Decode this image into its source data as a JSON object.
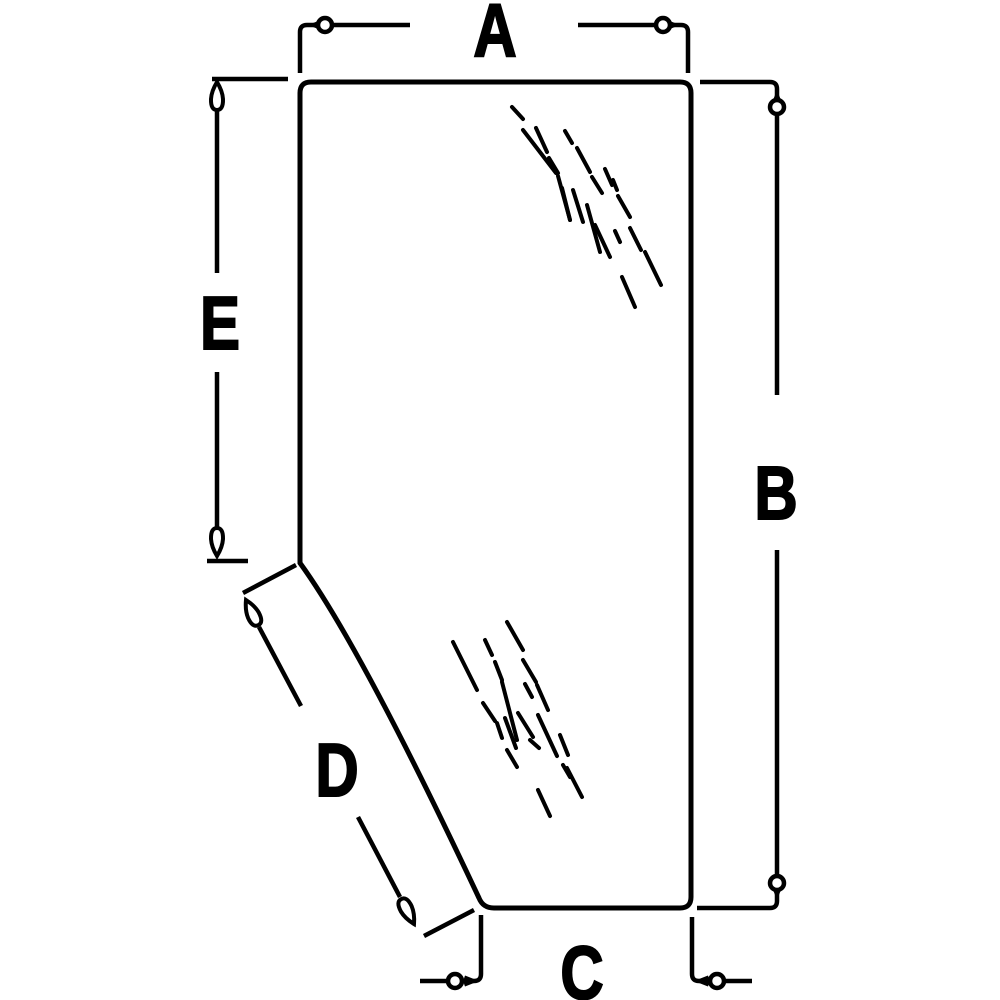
{
  "colors": {
    "background": "#ffffff",
    "line": "#000000"
  },
  "diagram": {
    "description": "technical-dimension-diagram-of-glass-panel",
    "canvas": {
      "width": 1000,
      "height": 1000
    },
    "glass_outline": "M 300 563 L 300 93 Q 300 82 311 82 L 680 82 Q 691 82 691 93 L 691 897 Q 691 908 680 908 L 494 908 Q 483 908 479 898 Q 361 647 300 563 Z",
    "hatch_clusters": [
      {
        "name": "upper-glass-shine",
        "strokes": [
          [
            512,
            107,
            523,
            119
          ],
          [
            523,
            130,
            556,
            173
          ],
          [
            536,
            128,
            547,
            152
          ],
          [
            549,
            158,
            558,
            173
          ],
          [
            565,
            131,
            572,
            143
          ],
          [
            558,
            176,
            570,
            220
          ],
          [
            577,
            148,
            590,
            172
          ],
          [
            562,
            188,
            570,
            220
          ],
          [
            573,
            190,
            583,
            222
          ],
          [
            592,
            177,
            602,
            193
          ],
          [
            605,
            169,
            612,
            185
          ],
          [
            587,
            205,
            600,
            252
          ],
          [
            595,
            225,
            610,
            257
          ],
          [
            613,
            180,
            617,
            190
          ],
          [
            618,
            196,
            630,
            217
          ],
          [
            615,
            231,
            620,
            242
          ],
          [
            630,
            228,
            641,
            250
          ],
          [
            645,
            252,
            661,
            285
          ],
          [
            622,
            277,
            635,
            307
          ]
        ]
      },
      {
        "name": "lower-glass-shine",
        "strokes": [
          [
            453,
            642,
            477,
            690
          ],
          [
            485,
            640,
            492,
            655
          ],
          [
            507,
            622,
            523,
            650
          ],
          [
            495,
            662,
            502,
            680
          ],
          [
            502,
            682,
            517,
            740
          ],
          [
            523,
            660,
            536,
            682
          ],
          [
            525,
            684,
            532,
            697
          ],
          [
            537,
            685,
            548,
            710
          ],
          [
            483,
            703,
            495,
            721
          ],
          [
            497,
            723,
            502,
            738
          ],
          [
            505,
            718,
            516,
            748
          ],
          [
            507,
            750,
            517,
            767
          ],
          [
            518,
            713,
            533,
            737
          ],
          [
            538,
            715,
            557,
            756
          ],
          [
            560,
            735,
            568,
            755
          ],
          [
            563,
            765,
            570,
            777
          ],
          [
            567,
            768,
            582,
            797
          ],
          [
            538,
            790,
            550,
            816
          ],
          [
            530,
            740,
            539,
            748
          ]
        ]
      }
    ],
    "dimensions": [
      {
        "label": "A",
        "paths": [
          "M 300 73 L 300 32 Q 300 25 307 25 L 410 25",
          "M 578 25 L 681 25 Q 688 25 688 32 L 688 73"
        ],
        "circles": [
          [
            325,
            25
          ],
          [
            663,
            25
          ]
        ],
        "arrows": [
          {
            "x": 308,
            "y": 25,
            "rot": 180
          },
          {
            "x": 680,
            "y": 25,
            "rot": 0
          }
        ],
        "teardrops": []
      },
      {
        "label": "B",
        "paths": [
          "M 700 82 L 770 82 Q 777 82 777 89 L 777 395",
          "M 777 550 L 777 901 Q 777 908 770 908 L 697 908"
        ],
        "circles": [
          [
            777,
            107
          ],
          [
            777,
            883
          ]
        ],
        "arrows": [
          {
            "x": 777,
            "y": 90,
            "rot": 270
          },
          {
            "x": 777,
            "y": 900,
            "rot": 90
          }
        ],
        "teardrops": []
      },
      {
        "label": "C",
        "paths": [
          "M 420 981 L 474 981 Q 481 981 481 974 L 481 915",
          "M 692 917 L 692 974 Q 692 981 699 981 L 752 981"
        ],
        "circles": [
          [
            455,
            981
          ],
          [
            717,
            981
          ]
        ],
        "arrows": [
          {
            "x": 479,
            "y": 981,
            "rot": 0
          },
          {
            "x": 694,
            "y": 981,
            "rot": 180
          }
        ],
        "teardrops": []
      },
      {
        "label": "D",
        "paths": [
          "M 296 565 L 243 593",
          "M 259 627 L 301 706",
          "M 358 817 L 400 897",
          "M 474 910 L 424 936"
        ],
        "circles": [],
        "arrows": [],
        "teardrops": [
          {
            "tipx": 246,
            "tipy": 600,
            "rot": 64
          },
          {
            "tipx": 414,
            "tipy": 924,
            "rot": 243
          }
        ]
      },
      {
        "label": "E",
        "paths": [
          "M 212 79 L 288 79",
          "M 217 110 L 217 273",
          "M 217 372 L 217 528",
          "M 207 561 L 248 561"
        ],
        "circles": [],
        "arrows": [],
        "teardrops": [
          {
            "tipx": 217,
            "tipy": 82,
            "rot": 90
          },
          {
            "tipx": 217,
            "tipy": 556,
            "rot": 270
          }
        ]
      }
    ]
  }
}
